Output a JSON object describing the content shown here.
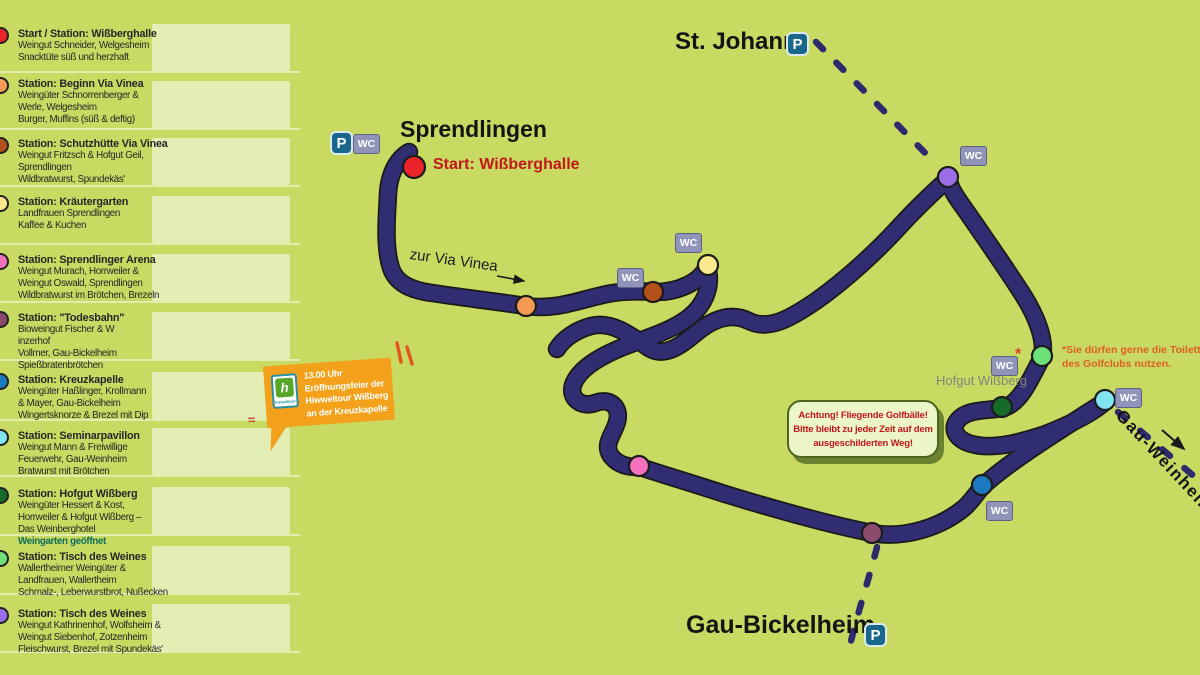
{
  "background": "#c8da62",
  "sidebar": {
    "box_color": "#e3eeb4",
    "stations": [
      {
        "top": 28,
        "box_top": 24,
        "dot": "#ea2428",
        "title": "Start / Station: Wißberghalle",
        "lines": [
          "Weingut Schneider, Welgesheim",
          "Snacktüte süß und herzhaft"
        ]
      },
      {
        "top": 78,
        "box_top": 81,
        "dot": "#f59a55",
        "title": "Station: Beginn Via Vinea",
        "lines": [
          "Weingüter Schnorrenberger &",
          "Werle, Welgesheim",
          "Burger, Muffins (süß & deftig)"
        ]
      },
      {
        "top": 138,
        "box_top": 138,
        "dot": "#b45019",
        "title": "Station: Schutzhütte Via Vinea",
        "lines": [
          "Weingut Fritzsch & Hofgut Geil,",
          "Sprendlingen",
          "Wildbratwurst, Spundekäs'"
        ]
      },
      {
        "top": 196,
        "box_top": 196,
        "dot": "#fae98c",
        "title": "Station: Kräutergarten",
        "lines": [
          "Landfrauen Sprendlingen",
          "Kaffee & Kuchen"
        ]
      },
      {
        "top": 254,
        "box_top": 254,
        "dot": "#f472bd",
        "title": "Station: Sprendlinger Arena",
        "lines": [
          "Weingut Murach, Horrweiler &",
          "Weingut Oswald, Sprendlingen",
          "Wildbratwurst im Brötchen, Brezeln"
        ]
      },
      {
        "top": 312,
        "box_top": 312,
        "dot": "#8c4b6d",
        "title": "Station: \"Todesbahn\"",
        "lines": [
          "Bioweingut Fischer & W",
          "inzerhof",
          "Vollmer, Gau-Bickelheim",
          "Spießbratenbrötchen"
        ]
      },
      {
        "top": 374,
        "box_top": 372,
        "dot": "#1b79c0",
        "title": "Station: Kreuzkapelle",
        "lines": [
          "Weingüter Haßlinger, Krollmann",
          "& Mayer, Gau-Bickelheim",
          "Wingertsknorze & Brezel mit Dip"
        ]
      },
      {
        "top": 430,
        "box_top": 428,
        "dot": "#82e4f0",
        "title": "Station: Seminarpavillon",
        "lines": [
          "Weingut Mann & Freiwillige",
          "Feuerwehr, Gau-Weinheim",
          "Bratwurst mit Brötchen"
        ]
      },
      {
        "top": 488,
        "box_top": 487,
        "dot": "#156b28",
        "title": "Station: Hofgut Wißberg",
        "lines": [
          "Weingüter Hessert & Kost,",
          "Horrweiler & Hofgut Wißberg –",
          "Das Weinberghotel"
        ],
        "note": "Weingarten geöffnet"
      },
      {
        "top": 551,
        "box_top": 546,
        "dot": "#6ee07a",
        "title": "Station: Tisch des Weines",
        "lines": [
          "Wallertheimer Weingüter &",
          "Landfrauen, Wallertheim",
          "Schmalz-, Leberwurstbrot, Nußecken"
        ]
      },
      {
        "top": 608,
        "box_top": 604,
        "dot": "#9b6ee8",
        "title": "Station: Tisch des Weines",
        "lines": [
          "Weingut Kathrinenhof, Wolfsheim &",
          "Weingut Siebenhof, Zotzenheim",
          "Fleischwurst, Brezel mit Spundekäs'"
        ]
      }
    ]
  },
  "map": {
    "route_color": "#312d73",
    "icons": {
      "p": "P",
      "wc": "WC"
    },
    "towns": [
      {
        "label": "Sprendlingen",
        "x": 400,
        "y": 116,
        "size": 23
      },
      {
        "label": "St. Johann",
        "x": 675,
        "y": 28,
        "size": 24
      },
      {
        "label": "Gau-Bickelheim",
        "x": 686,
        "y": 611,
        "size": 25
      }
    ],
    "p_icons": [
      {
        "x": 330,
        "y": 131
      },
      {
        "x": 786,
        "y": 32
      },
      {
        "x": 864,
        "y": 623
      }
    ],
    "wc_icons": [
      {
        "x": 353,
        "y": 134
      },
      {
        "x": 617,
        "y": 268
      },
      {
        "x": 675,
        "y": 233
      },
      {
        "x": 960,
        "y": 146
      },
      {
        "x": 991,
        "y": 356
      },
      {
        "x": 1115,
        "y": 388
      },
      {
        "x": 986,
        "y": 501
      }
    ],
    "markers": [
      {
        "color": "#ea2428",
        "x": 414,
        "y": 167,
        "r": 11
      },
      {
        "color": "#f59a55",
        "x": 526,
        "y": 306,
        "r": 10
      },
      {
        "color": "#b45019",
        "x": 653,
        "y": 292,
        "r": 10
      },
      {
        "color": "#fae98c",
        "x": 708,
        "y": 265,
        "r": 10
      },
      {
        "color": "#f472bd",
        "x": 639,
        "y": 466,
        "r": 10
      },
      {
        "color": "#8c4b6d",
        "x": 872,
        "y": 533,
        "r": 10
      },
      {
        "color": "#1b79c0",
        "x": 982,
        "y": 485,
        "r": 10
      },
      {
        "color": "#82e4f0",
        "x": 1105,
        "y": 400,
        "r": 10
      },
      {
        "color": "#156b28",
        "x": 1002,
        "y": 407,
        "r": 10
      },
      {
        "color": "#6ee07a",
        "x": 1042,
        "y": 356,
        "r": 10
      },
      {
        "color": "#9b6ee8",
        "x": 948,
        "y": 177,
        "r": 10
      }
    ],
    "start_label": "Start: Wißberghalle",
    "via_vinea_label": "zur Via Vinea",
    "hofgut_label": "Hofgut Wißberg",
    "gau_weinheim_label": "Gau-Weinheim",
    "asterisk": "*",
    "squiggle": "≈",
    "toilet_note": [
      "*Sie dürfen gerne die Toiletten",
      "des Golfclubs nutzen."
    ],
    "golf_warning": [
      "Achtung! Fliegende Golfbälle!",
      "Bitte bleibt zu jeder Zeit auf dem",
      "ausgeschilderten Weg!"
    ],
    "flag": {
      "lines": [
        "13.00 Uhr",
        "Eröffnungsfeier der",
        "Hiwweltour Wißberg",
        "an der Kreuzkapelle"
      ],
      "logo_letter": "h",
      "logo_text": "hiwweltour"
    }
  }
}
